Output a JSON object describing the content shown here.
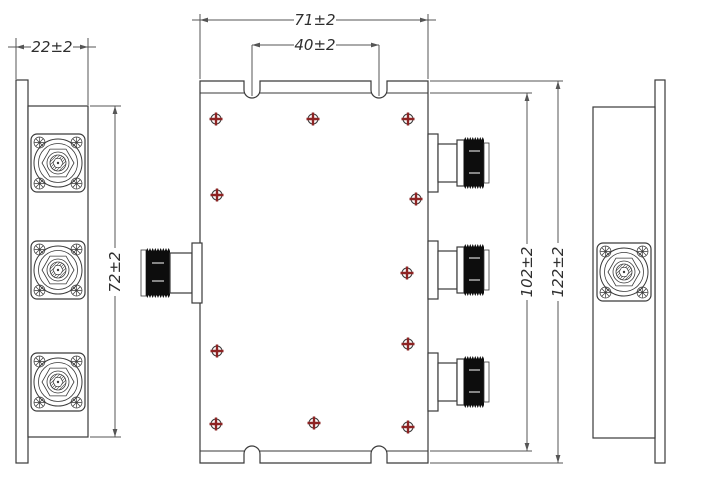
{
  "dimensions": {
    "side_width": "22±2",
    "side_height": "72±2",
    "body_width": "71±2",
    "slot_spacing": "40±2",
    "inner_height": "102±2",
    "overall_height": "122±2"
  },
  "colors": {
    "background": "#ffffff",
    "line": "#3a3a3a",
    "dim": "#555555",
    "text": "#2e2e2e",
    "screw_red": "#8e2424",
    "connector_black": "#0d0d0d"
  },
  "icons": {
    "body_screw": "phillips-screw-icon",
    "flange_screw": "flange-screw-icon",
    "connector_face": "n-connector-face-icon",
    "connector_side": "n-connector-side-icon"
  }
}
